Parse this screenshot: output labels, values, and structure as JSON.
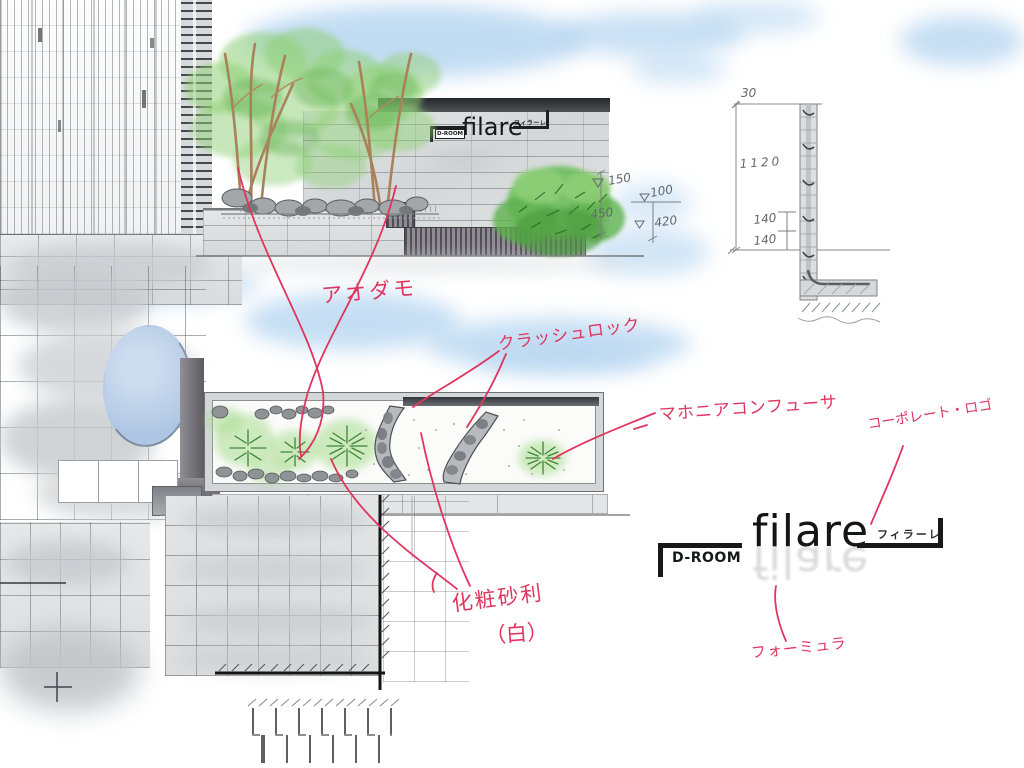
{
  "annotations": {
    "aodamo": "アオダモ",
    "crush_rock": "クラッシュロック",
    "mahonia": "マホニアコンフューサ",
    "corporate_logo": "コーポレート・ロゴ",
    "gravel_line1": "化粧砂利",
    "gravel_line2": "（白）",
    "formula": "フォーミュラ"
  },
  "wall_sign": {
    "droom": "D-ROOM",
    "name": "filare",
    "katakana": "フィラーレ"
  },
  "logo": {
    "droom": "D-ROOM",
    "name": "filare",
    "katakana": "フィラーレ"
  },
  "dimensions": {
    "elevation": {
      "planting_height": "150",
      "wall_height": "450",
      "cap_height": "100",
      "fence_height": "420"
    },
    "section": {
      "top_width": "30",
      "total_height": "1120",
      "course_a": "140",
      "course_b": "140"
    }
  },
  "colors": {
    "annotation_pink": "#e0355e",
    "sky_blue": "#aed1ef",
    "foliage_green": "#8fd077",
    "shrub_green": "#5cb14c",
    "wall_gray": "#d9dbdc",
    "stripe_dark": "#514d56",
    "logo_black": "#17181a"
  }
}
